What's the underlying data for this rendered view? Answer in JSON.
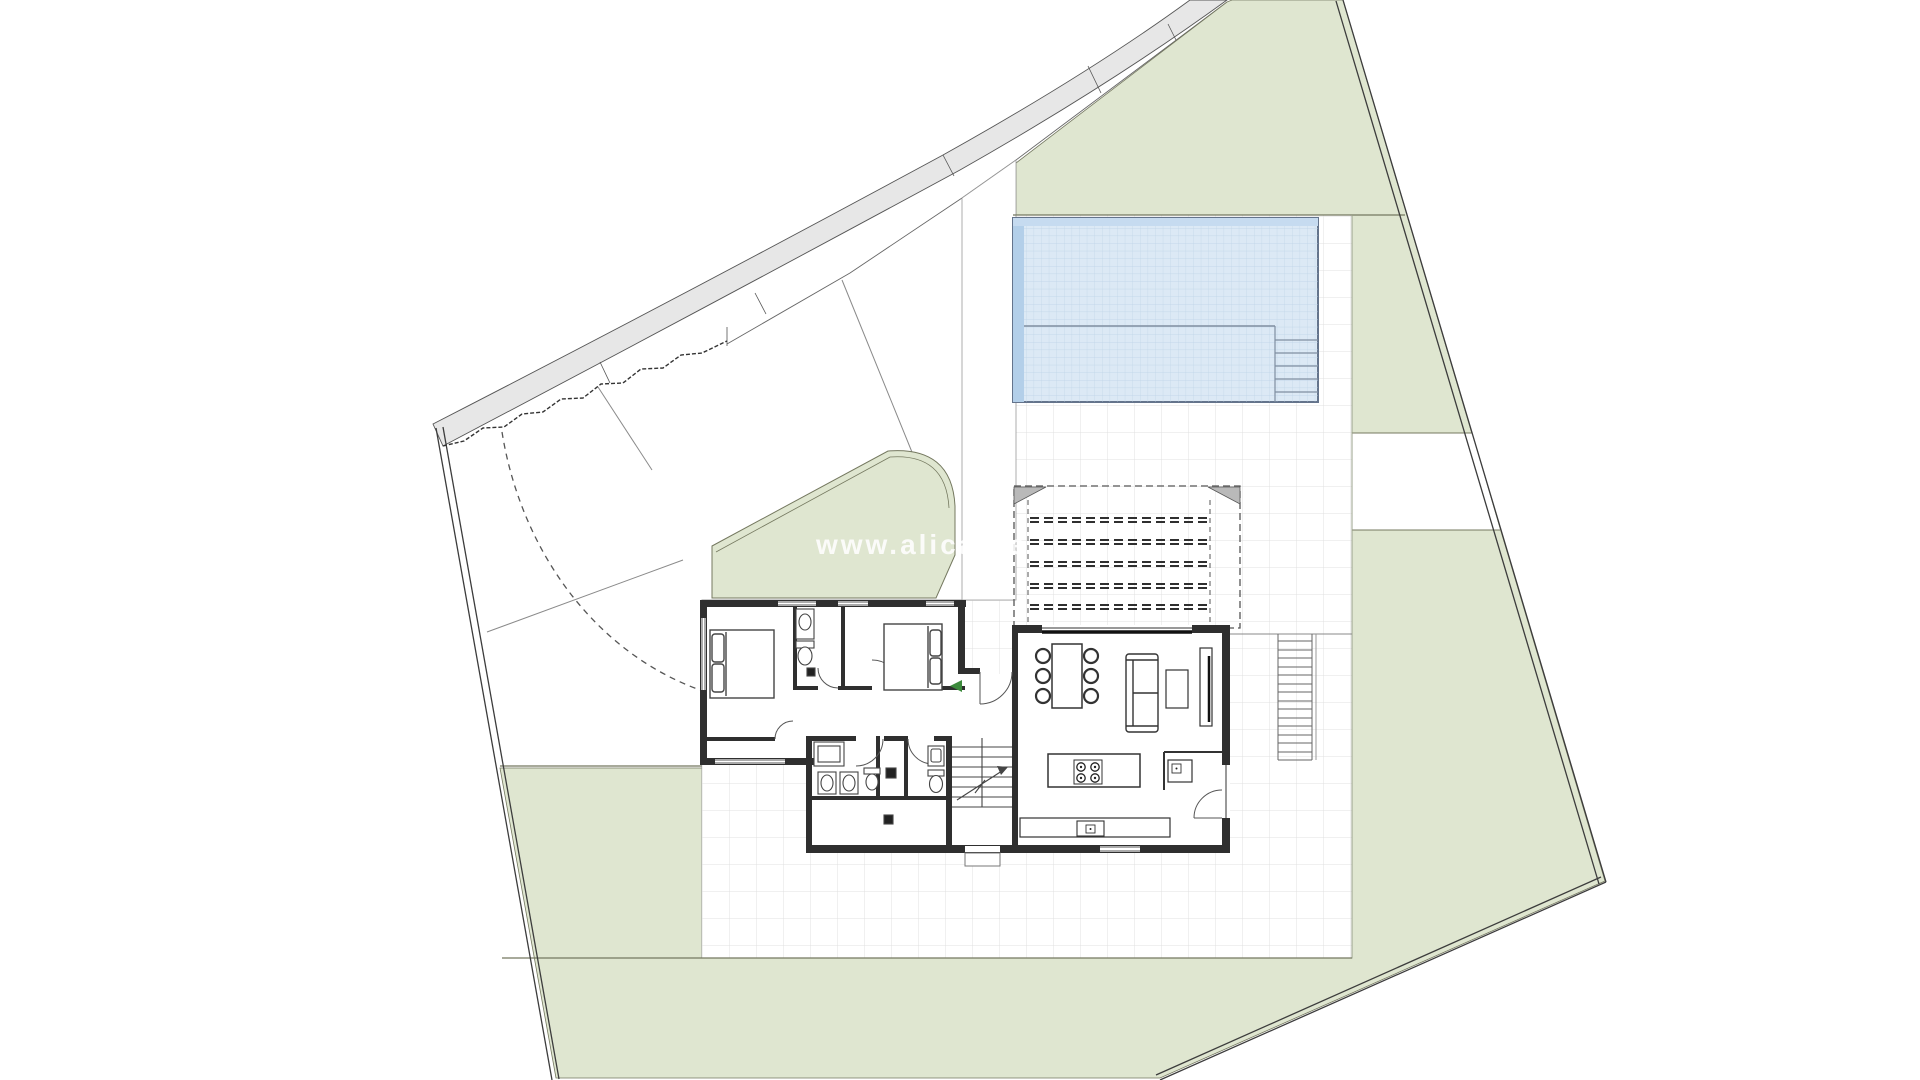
{
  "document": {
    "kind": "architectural site plan with ground-floor plan",
    "orientation": "plot rotated, road along upper-left edge"
  },
  "watermark": "www.alicante",
  "palette": {
    "background": "#ffffff",
    "garden_green": "#dfe6d0",
    "garden_edge": "#74785f",
    "road_gray": "#e7e7e7",
    "pool_water": "#dce9f5",
    "pool_border_band": "#b3cfe9",
    "pool_grid": "#bcd2e6",
    "wall_dark": "#2f2f2f",
    "terrace_grid": "#e0e0e0",
    "boundary_line": "#3c3c3c",
    "entry_arrow": "#3c8a3c"
  },
  "site": {
    "boundary": "irregular quadrilateral, double-line border",
    "zones": [
      "road band (top-left)",
      "white driveway parcels",
      "front garden (rounded corner)",
      "main garden wrapping right and bottom",
      "paved terrace with grid",
      "pool terrace"
    ],
    "driveway_path": "dashed arc from road to house entry"
  },
  "pool": {
    "shape": "rectangle",
    "lane_divider": true,
    "corner_steps": 5,
    "tiled": true
  },
  "pergola": {
    "beams": 5,
    "corner_gussets": 2,
    "style": "dashed overhead structure"
  },
  "house": {
    "rooms": [
      "bedroom 1",
      "bedroom 2",
      "en-suite bathroom",
      "hallway",
      "bathroom 2",
      "wc",
      "storage",
      "entry hall",
      "stairwell",
      "living-dining room",
      "kitchen"
    ],
    "furniture": {
      "beds": 2,
      "dining_chairs": 6,
      "dining_table": 1,
      "sofa": 1,
      "coffee_table": 1,
      "tv_unit": 1,
      "kitchen_island_burners": 4,
      "sinks": 6,
      "toilets": 3,
      "shower": 1
    },
    "stairs": {
      "interior_steps": 7,
      "exterior_steps": 14
    }
  }
}
